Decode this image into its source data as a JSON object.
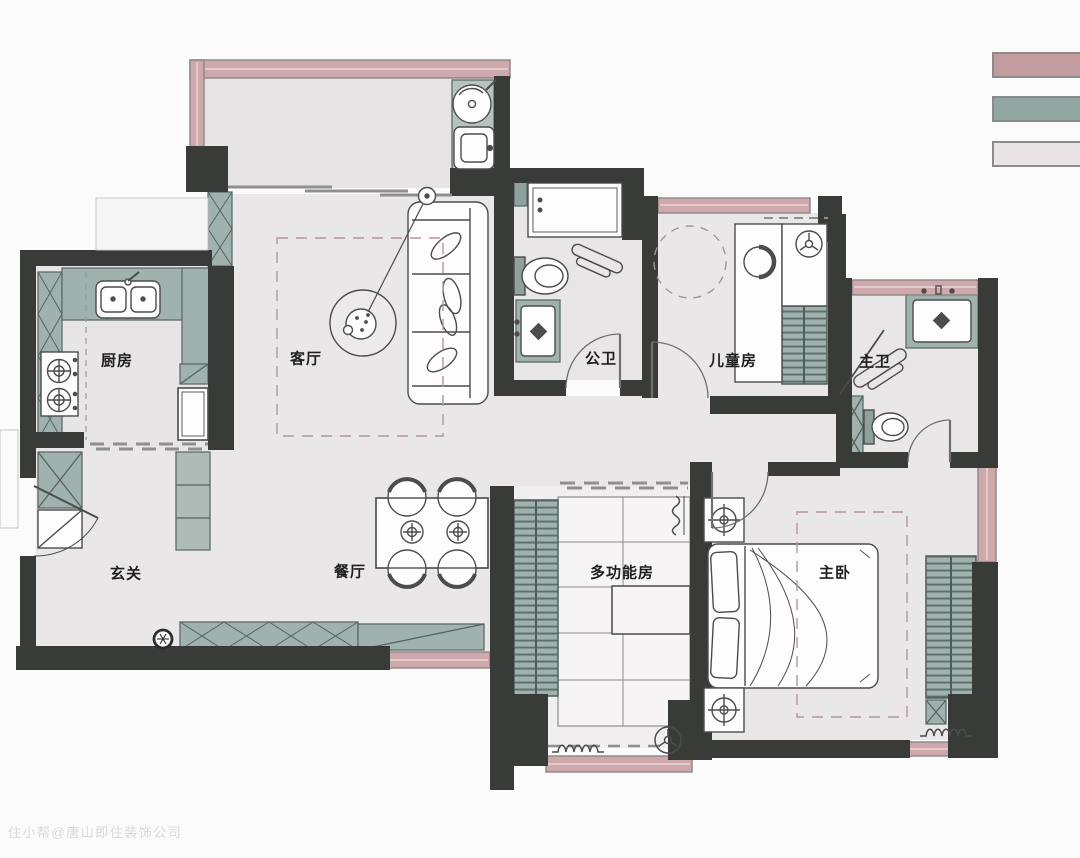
{
  "plan": {
    "rooms": [
      {
        "id": "kitchen",
        "label": "厨房"
      },
      {
        "id": "living",
        "label": "客厅"
      },
      {
        "id": "public-bath",
        "label": "公卫"
      },
      {
        "id": "kids-room",
        "label": "儿童房"
      },
      {
        "id": "master-bath",
        "label": "主卫"
      },
      {
        "id": "entry",
        "label": "玄关"
      },
      {
        "id": "dining",
        "label": "餐厅"
      },
      {
        "id": "multi-room",
        "label": "多功能房"
      },
      {
        "id": "master-bedroom",
        "label": "主卧"
      }
    ]
  },
  "legend": {
    "swatches": [
      {
        "name": "pink-wall",
        "color": "#c39ca0"
      },
      {
        "name": "sage-cabinet",
        "color": "#92a6a2"
      },
      {
        "name": "light-floor",
        "color": "#eae4e6"
      }
    ]
  },
  "watermark": {
    "text": "住小帮@唐山即住装饰公司"
  }
}
